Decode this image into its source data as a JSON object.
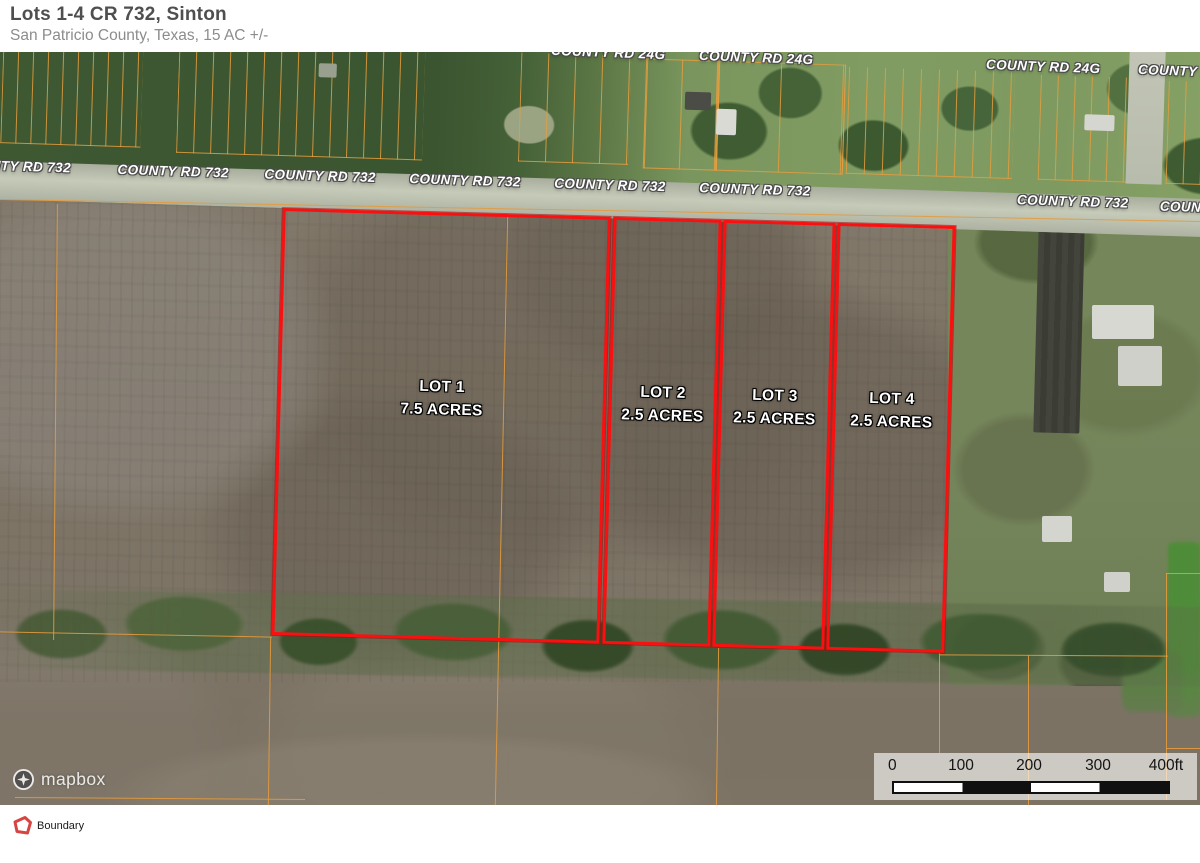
{
  "header": {
    "title": "Lots 1-4 CR 732, Sinton",
    "subtitle": "San Patricio County, Texas, 15 AC +/-"
  },
  "map": {
    "road_732_labels": [
      {
        "text": "COUNTY RD 732"
      },
      {
        "text": "COUNTY RD 732"
      },
      {
        "text": "COUNTY RD 732"
      },
      {
        "text": "COUNTY RD 732"
      },
      {
        "text": "COUNTY RD 732"
      },
      {
        "text": "COUNTY RD 732"
      },
      {
        "text": "COUNTY RD 732"
      },
      {
        "text": "COUNTY RD 732"
      }
    ],
    "road_24g_labels": [
      {
        "text": "COUNTY RD 24G"
      },
      {
        "text": "COUNTY RD 24G"
      },
      {
        "text": "COUNTY RD 24G"
      },
      {
        "text": "COUNTY RD 24G"
      }
    ],
    "lots": [
      {
        "name": "LOT 1",
        "acres": "7.5 ACRES"
      },
      {
        "name": "LOT 2",
        "acres": "2.5 ACRES"
      },
      {
        "name": "LOT 3",
        "acres": "2.5 ACRES"
      },
      {
        "name": "LOT 4",
        "acres": "2.5 ACRES"
      }
    ],
    "scale_bar": {
      "ticks": [
        "0",
        "100",
        "200",
        "300",
        "400ft"
      ]
    },
    "attribution": {
      "logo_text": "mapbox"
    }
  },
  "legend": {
    "items": [
      {
        "label": "Boundary",
        "icon": "boundary-polygon-icon",
        "color": "#d64541"
      }
    ]
  },
  "colors": {
    "boundary_red": "#fa1010",
    "parcel_orange": "#e49a3c",
    "legend_red": "#d64541"
  }
}
